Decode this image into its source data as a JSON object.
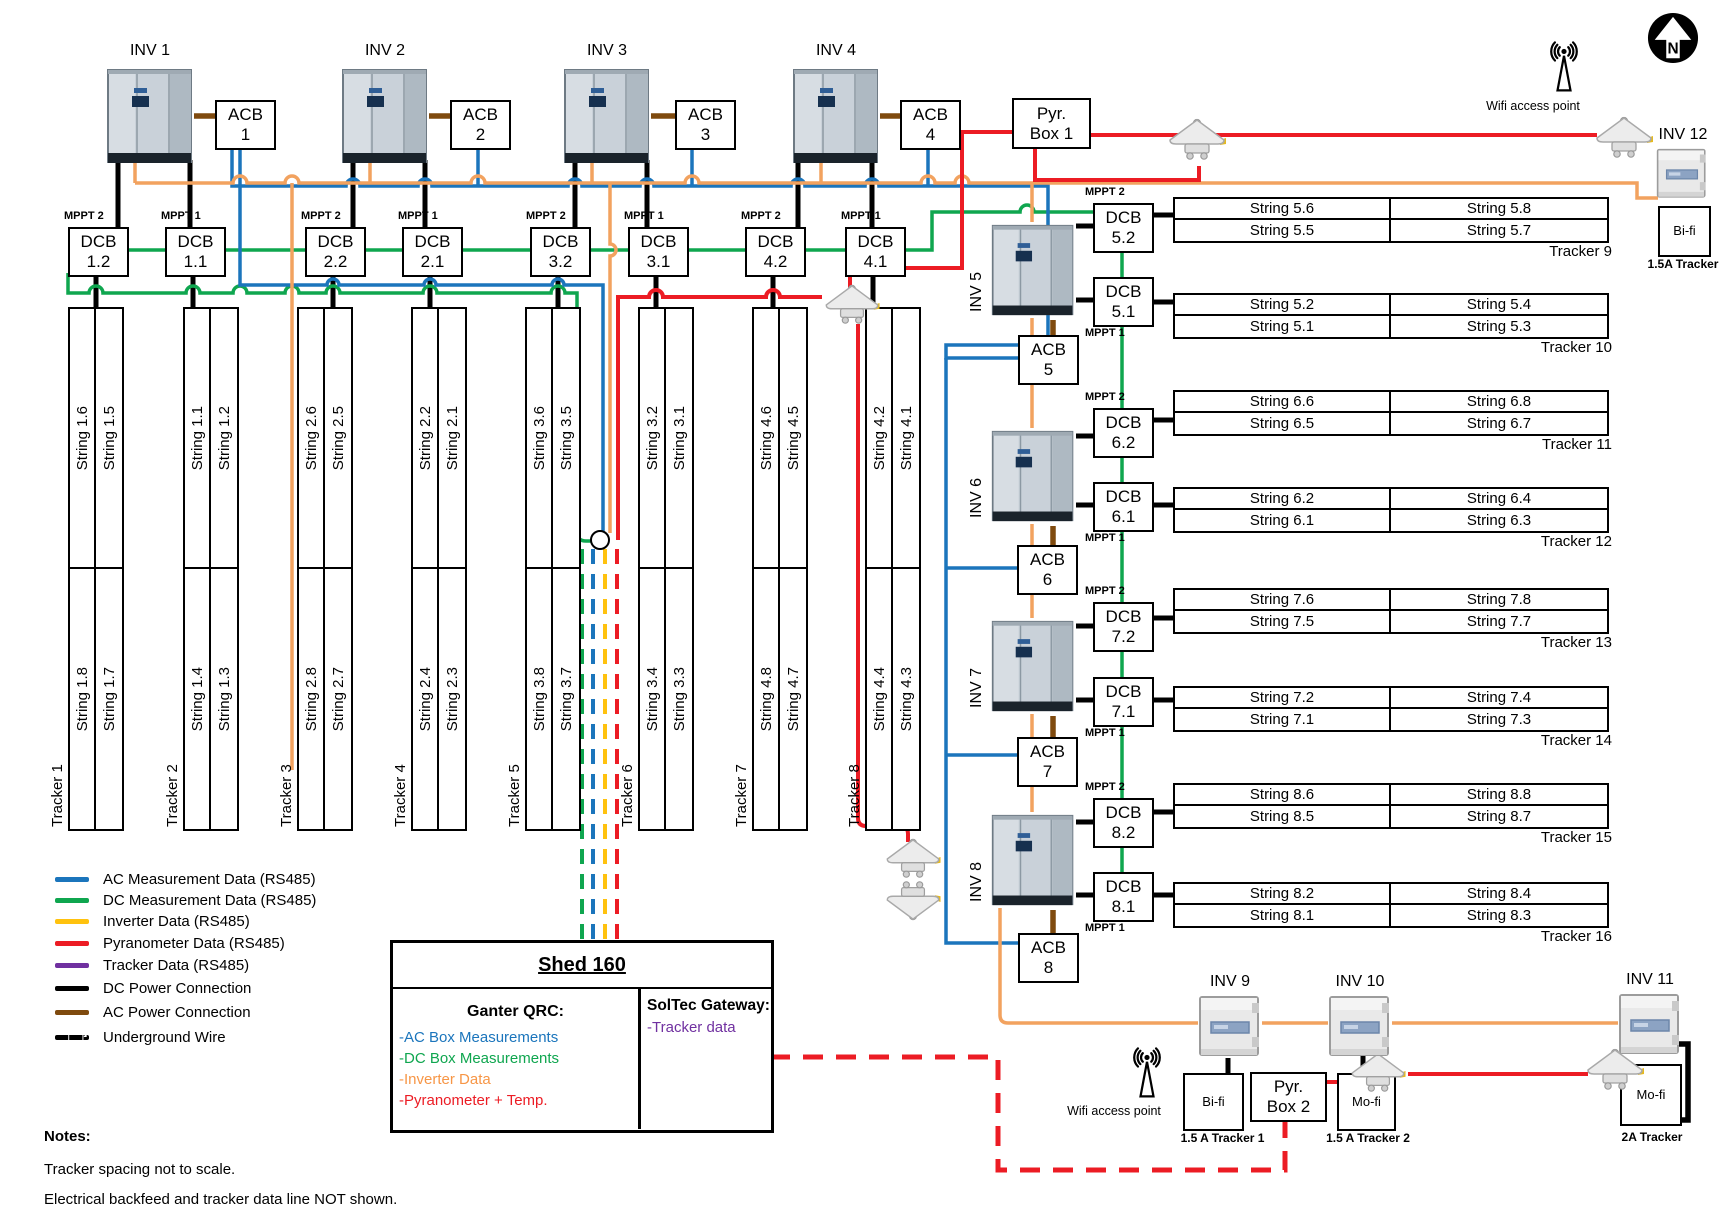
{
  "colors": {
    "ac_blue": "#1B75BC",
    "dc_green": "#0FA64F",
    "inverter_yellow": "#FFC20E",
    "inverter_wire_orange": "#F2A25F",
    "pyranometer_red": "#EC1C24",
    "tracker_purple": "#7030A0",
    "dc_black": "#000000",
    "ac_brown": "#7F4A0E",
    "shed_orange": "#F79646"
  },
  "inverters": {
    "top": [
      "INV 1",
      "INV 2",
      "INV 3",
      "INV 4"
    ],
    "right": [
      "INV 5",
      "INV 6",
      "INV 7",
      "INV 8"
    ],
    "bottom": [
      "INV 9",
      "INV 10",
      "INV 11"
    ],
    "corner": "INV 12"
  },
  "acb_boxes": [
    "ACB\n1",
    "ACB\n2",
    "ACB\n3",
    "ACB\n4",
    "ACB\n5",
    "ACB\n6",
    "ACB\n7",
    "ACB\n8"
  ],
  "dcb_left": [
    {
      "label": "DCB\n1.2",
      "mppt": "MPPT 2"
    },
    {
      "label": "DCB\n1.1",
      "mppt": "MPPT 1"
    },
    {
      "label": "DCB\n2.2",
      "mppt": "MPPT 2"
    },
    {
      "label": "DCB\n2.1",
      "mppt": "MPPT 1"
    },
    {
      "label": "DCB\n3.2",
      "mppt": "MPPT 2"
    },
    {
      "label": "DCB\n3.1",
      "mppt": "MPPT 1"
    },
    {
      "label": "DCB\n4.2",
      "mppt": "MPPT 2"
    },
    {
      "label": "DCB\n4.1",
      "mppt": "MPPT 1"
    }
  ],
  "dcb_right": [
    {
      "label": "DCB\n5.2",
      "mppt": "MPPT 2"
    },
    {
      "label": "DCB\n5.1",
      "mppt": "MPPT 1"
    },
    {
      "label": "DCB\n6.2",
      "mppt": "MPPT 2"
    },
    {
      "label": "DCB\n6.1",
      "mppt": "MPPT 1"
    },
    {
      "label": "DCB\n7.2",
      "mppt": "MPPT 2"
    },
    {
      "label": "DCB\n7.1",
      "mppt": "MPPT 1"
    },
    {
      "label": "DCB\n8.2",
      "mppt": "MPPT 2"
    },
    {
      "label": "DCB\n8.1",
      "mppt": "MPPT 1"
    }
  ],
  "pyr_boxes": [
    "Pyr.\nBox 1",
    "Pyr.\nBox 2"
  ],
  "left_trackers": [
    {
      "name": "Tracker 1",
      "top": [
        "String 1.6",
        "String 1.5"
      ],
      "bottom": [
        "String 1.8",
        "String 1.7"
      ]
    },
    {
      "name": "Tracker 2",
      "top": [
        "String 1.1",
        "String 1.2"
      ],
      "bottom": [
        "String 1.4",
        "String 1.3"
      ]
    },
    {
      "name": "Tracker 3",
      "top": [
        "String 2.6",
        "String 2.5"
      ],
      "bottom": [
        "String 2.8",
        "String 2.7"
      ]
    },
    {
      "name": "Tracker 4",
      "top": [
        "String 2.2",
        "String 2.1"
      ],
      "bottom": [
        "String 2.4",
        "String 2.3"
      ]
    },
    {
      "name": "Tracker 5",
      "top": [
        "String 3.6",
        "String 3.5"
      ],
      "bottom": [
        "String 3.8",
        "String 3.7"
      ]
    },
    {
      "name": "Tracker 6",
      "top": [
        "String 3.2",
        "String 3.1"
      ],
      "bottom": [
        "String 3.4",
        "String 3.3"
      ]
    },
    {
      "name": "Tracker 7",
      "top": [
        "String 4.6",
        "String 4.5"
      ],
      "bottom": [
        "String 4.8",
        "String 4.7"
      ]
    },
    {
      "name": "Tracker 8",
      "top": [
        "String 4.2",
        "String 4.1"
      ],
      "bottom": [
        "String 4.4",
        "String 4.3"
      ]
    }
  ],
  "right_trackers": [
    {
      "name": "Tracker 9",
      "rows": [
        [
          "String 5.6",
          "String 5.8"
        ],
        [
          "String 5.5",
          "String 5.7"
        ]
      ]
    },
    {
      "name": "Tracker 10",
      "rows": [
        [
          "String 5.2",
          "String 5.4"
        ],
        [
          "String 5.1",
          "String 5.3"
        ]
      ]
    },
    {
      "name": "Tracker 11",
      "rows": [
        [
          "String 6.6",
          "String 6.8"
        ],
        [
          "String 6.5",
          "String 6.7"
        ]
      ]
    },
    {
      "name": "Tracker 12",
      "rows": [
        [
          "String 6.2",
          "String 6.4"
        ],
        [
          "String 6.1",
          "String 6.3"
        ]
      ]
    },
    {
      "name": "Tracker 13",
      "rows": [
        [
          "String 7.6",
          "String 7.8"
        ],
        [
          "String 7.5",
          "String 7.7"
        ]
      ]
    },
    {
      "name": "Tracker 14",
      "rows": [
        [
          "String 7.2",
          "String 7.4"
        ],
        [
          "String 7.1",
          "String 7.3"
        ]
      ]
    },
    {
      "name": "Tracker 15",
      "rows": [
        [
          "String 8.6",
          "String 8.8"
        ],
        [
          "String 8.5",
          "String 8.7"
        ]
      ]
    },
    {
      "name": "Tracker 16",
      "rows": [
        [
          "String 8.2",
          "String 8.4"
        ],
        [
          "String 8.1",
          "String 8.3"
        ]
      ]
    }
  ],
  "comm_boxes": {
    "bifi_top": "Bi-fi",
    "bifi_top_sub": "1.5A Tracker",
    "bifi_bottom": "Bi-fi",
    "bifi_bottom_sub": "1.5 A Tracker 1",
    "mofi_1": "Mo-fi",
    "mofi_1_sub": "1.5 A Tracker 2",
    "mofi_2": "Mo-fi",
    "mofi_2_sub": "2A Tracker"
  },
  "wifi": {
    "top_label": "Wifi access point",
    "bottom_label": "Wifi access point"
  },
  "compass": {
    "letter": "N"
  },
  "legend": [
    {
      "label": "AC Measurement Data (RS485)",
      "color": "ac_blue",
      "style": "solid"
    },
    {
      "label": "DC Measurement Data (RS485)",
      "color": "dc_green",
      "style": "solid"
    },
    {
      "label": "Inverter Data (RS485)",
      "color": "inverter_yellow",
      "style": "solid"
    },
    {
      "label": "Pyranometer Data (RS485)",
      "color": "pyranometer_red",
      "style": "solid"
    },
    {
      "label": "Tracker Data (RS485)",
      "color": "tracker_purple",
      "style": "solid"
    },
    {
      "label": "DC Power Connection",
      "color": "dc_black",
      "style": "solid"
    },
    {
      "label": "AC Power Connection",
      "color": "ac_brown",
      "style": "solid"
    },
    {
      "label": "Underground Wire",
      "color": "dc_black",
      "style": "dashed"
    }
  ],
  "shed": {
    "title": "Shed 160",
    "left_title": "Ganter QRC:",
    "left_items": [
      {
        "text": "-AC Box Measurements",
        "color": "ac_blue"
      },
      {
        "text": "-DC Box Measurements",
        "color": "dc_green"
      },
      {
        "text": "-Inverter Data",
        "color": "shed_orange"
      },
      {
        "text": "-Pyranometer + Temp.",
        "color": "pyranometer_red"
      }
    ],
    "right_title": "SolTec Gateway:",
    "right_items": [
      {
        "text": "-Tracker data",
        "color": "tracker_purple"
      }
    ]
  },
  "notes": {
    "heading": "Notes:",
    "lines": [
      "Tracker spacing not to scale.",
      "Electrical backfeed and tracker data line NOT shown."
    ]
  }
}
